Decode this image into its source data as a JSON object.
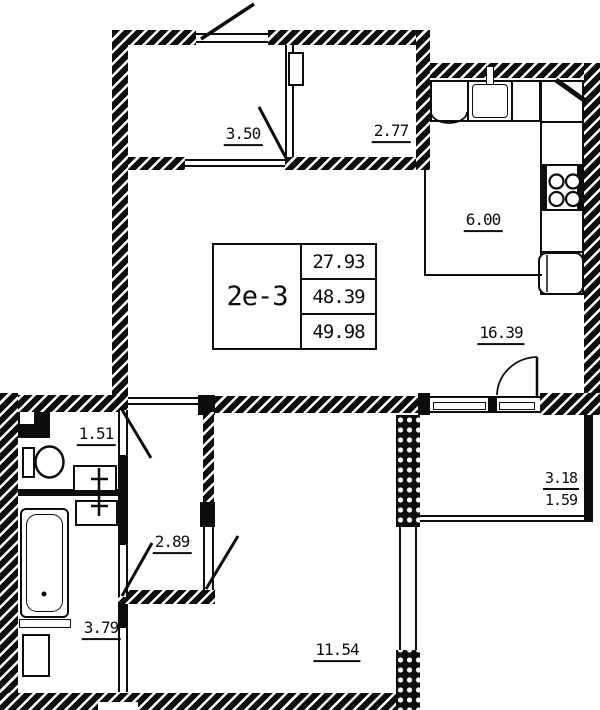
{
  "plan": {
    "title_block": {
      "unit": "2е-3",
      "rows": [
        "27.93",
        "48.39",
        "49.98"
      ]
    },
    "rooms": {
      "hall": {
        "area": "3.50"
      },
      "wardrobe": {
        "area": "2.77"
      },
      "kitchen": {
        "area": "6.00"
      },
      "living": {
        "area": "16.39"
      },
      "wc": {
        "area": "1.51"
      },
      "corridor": {
        "area": "2.89"
      },
      "bathroom": {
        "area": "3.79"
      },
      "bedroom": {
        "area": "11.54"
      }
    },
    "balcony": {
      "area_full": "3.18",
      "area_coef": "1.59"
    },
    "fixtures": [
      "entrance-door",
      "toilet",
      "washbasin",
      "washbasin",
      "bathtub",
      "washing-machine",
      "kitchen-sink",
      "stove",
      "refrigerator",
      "vent-flue"
    ],
    "colors": {
      "ink": "#0d0d0d",
      "paper": "#ffffff"
    }
  }
}
